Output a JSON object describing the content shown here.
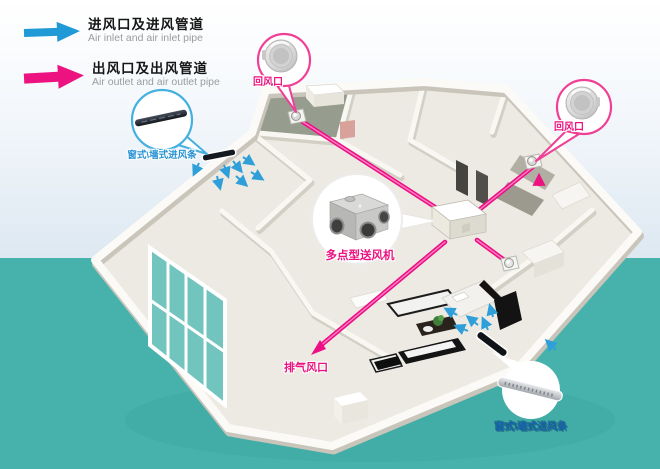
{
  "legend": {
    "inlet": {
      "zh": "进风口及进风管道",
      "en": "Air inlet and air inlet pipe",
      "color": "#1f9ad6"
    },
    "outlet": {
      "zh": "出风口及出风管道",
      "en": "Air outlet and air outlet pipe",
      "color": "#ec1380"
    }
  },
  "callouts": {
    "return_air_top": "回风口",
    "return_air_right": "回风口",
    "inlet_strip_left": "窗式\\墙式进风条",
    "inlet_strip_bottom": "窗式\\墙式进风条",
    "fan_unit": "多点型送风机",
    "exhaust_vent": "排气风口"
  },
  "colors": {
    "accent_pink": "#ec1380",
    "accent_blue": "#1f9ad6",
    "small_arrow_blue": "#2f9fda",
    "background_teal": "#47b1ac",
    "house_wall": "#fbfaf6",
    "house_floor": "#eceae2",
    "dark_room_floor": "#969c8e"
  },
  "icons": {
    "inlet_arrow": "blue-right-arrow",
    "outlet_arrow": "pink-right-arrow",
    "round_diffuser": "circular-return-vent",
    "inlet_strip": "slim-vent-strip",
    "fan_unit": "multi-port-fan-box",
    "ceiling_vent": "small-ceiling-diffuser"
  }
}
